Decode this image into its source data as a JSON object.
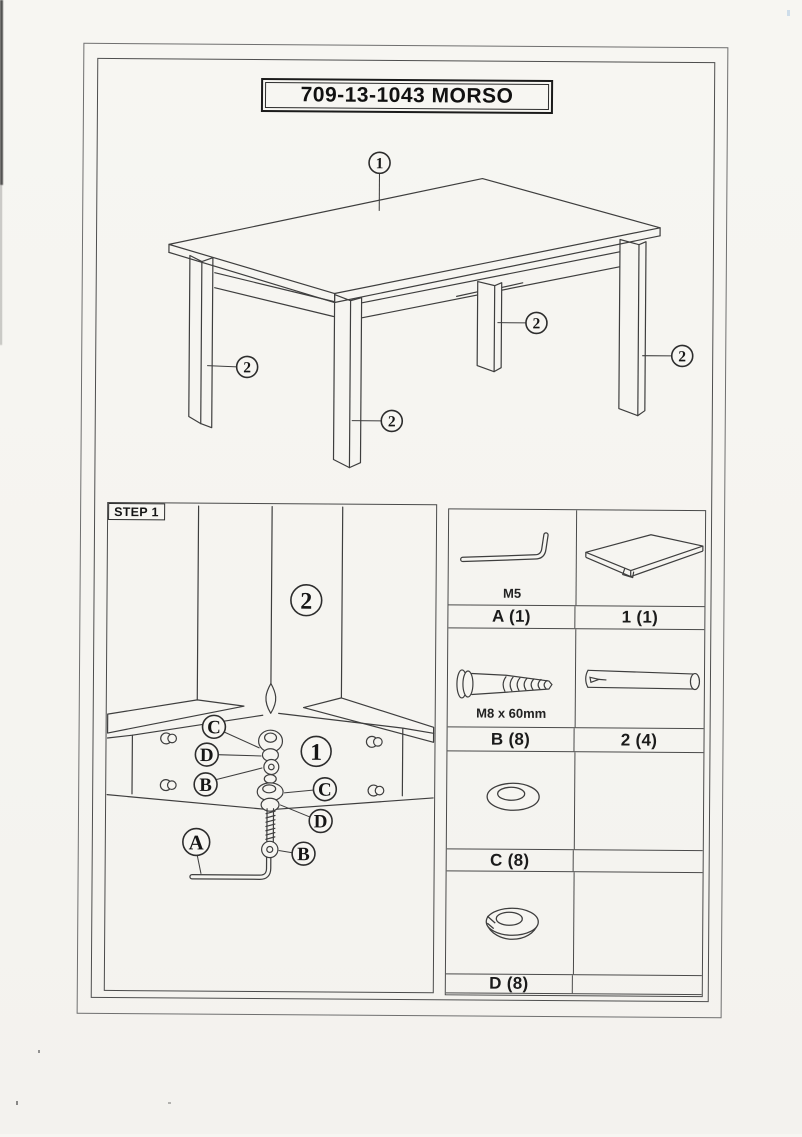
{
  "title": "709-13-1043 MORSO",
  "overview": {
    "tabletop_callout": "1",
    "leg_callout": "2"
  },
  "step1": {
    "heading": "STEP 1",
    "leg_label": "2",
    "bracket_label": "1",
    "washer_label": "C",
    "lock_washer_label": "D",
    "bolt_label": "B",
    "allen_key_label": "A"
  },
  "parts_table": {
    "rows": [
      {
        "left_code": "A (1)",
        "left_spec": "M5",
        "right_code": "1 (1)",
        "right_spec": ""
      },
      {
        "left_code": "B (8)",
        "left_spec": "M8 x 60mm",
        "right_code": "2 (4)",
        "right_spec": ""
      },
      {
        "left_code": "C (8)",
        "left_spec": "",
        "right_code": "",
        "right_spec": ""
      },
      {
        "left_code": "D (8)",
        "left_spec": "",
        "right_code": "",
        "right_spec": ""
      }
    ]
  },
  "colors": {
    "paper": "#f6f5f1",
    "ink": "#3e3e3e",
    "text": "#1b1b1b"
  }
}
